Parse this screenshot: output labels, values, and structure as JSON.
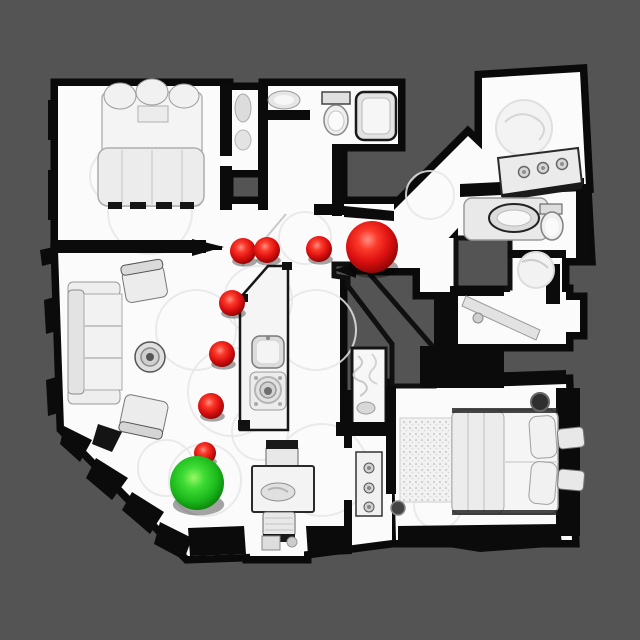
{
  "canvas": {
    "width": 640,
    "height": 640
  },
  "palette": {
    "background": "#545454",
    "floor": "#fbfbfb",
    "wall": "#0b0b0b",
    "furniture": "#ededed",
    "scan_circle": "#e6e6e6",
    "waypoint_red": "#dd1010",
    "waypoint_red_highlight": "#ff9085",
    "waypoint_red_dark": "#860505",
    "goal_green": "#1cba1c",
    "goal_green_highlight": "#9bf768",
    "goal_green_dark": "#087a08"
  },
  "markers": {
    "items": [
      {
        "id": "waypoint-1",
        "role": "waypoint",
        "x": 243,
        "y": 251,
        "r": 13
      },
      {
        "id": "waypoint-2",
        "role": "waypoint",
        "x": 267,
        "y": 250,
        "r": 13
      },
      {
        "id": "waypoint-3",
        "role": "waypoint",
        "x": 319,
        "y": 249,
        "r": 13
      },
      {
        "id": "target-sphere",
        "role": "target",
        "x": 372,
        "y": 247,
        "r": 26
      },
      {
        "id": "waypoint-4",
        "role": "waypoint",
        "x": 232,
        "y": 303,
        "r": 13
      },
      {
        "id": "waypoint-5",
        "role": "waypoint",
        "x": 222,
        "y": 354,
        "r": 13
      },
      {
        "id": "waypoint-6",
        "role": "waypoint",
        "x": 211,
        "y": 406,
        "r": 13
      },
      {
        "id": "waypoint-7",
        "role": "waypoint",
        "x": 205,
        "y": 453,
        "r": 11
      },
      {
        "id": "start-sphere",
        "role": "start",
        "x": 197,
        "y": 483,
        "r": 27
      }
    ]
  }
}
